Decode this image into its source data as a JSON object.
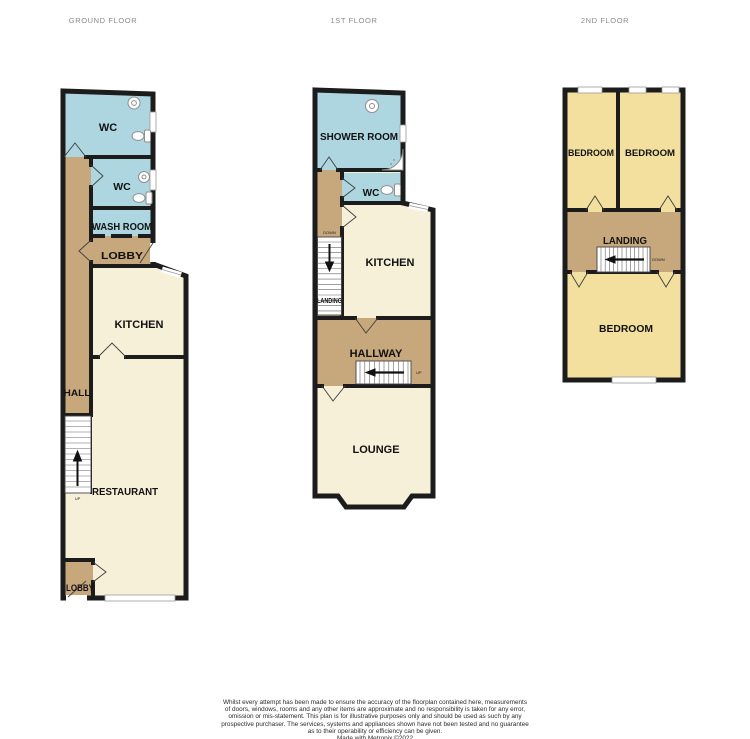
{
  "titles": {
    "ground": "GROUND FLOOR",
    "first": "1ST FLOOR",
    "second": "2ND FLOOR"
  },
  "colors": {
    "wall": "#1c1c1c",
    "cream": "#f6f0d8",
    "blue": "#aed6e0",
    "tan": "#c7a77c",
    "yellow": "#f3e09f",
    "title_gray": "#8a8a8a"
  },
  "ground": {
    "rooms": {
      "wc1": "WC",
      "wc2": "WC",
      "wash": "WASH ROOM",
      "lobby1": "LOBBY",
      "kitchen": "KITCHEN",
      "hall": "HALL",
      "restaurant": "RESTAURANT",
      "lobby2": "LOBBY"
    },
    "stairs": {
      "up": "UP"
    }
  },
  "first": {
    "rooms": {
      "shower": "SHOWER ROOM",
      "wc": "WC",
      "kitchen": "KITCHEN",
      "landing": "LANDING",
      "hallway": "HALLWAY",
      "lounge": "LOUNGE"
    },
    "stairs": {
      "down": "DOWN",
      "up": "UP"
    }
  },
  "second": {
    "rooms": {
      "bedroom1": "BEDROOM",
      "bedroom2": "BEDROOM",
      "landing": "LANDING",
      "bedroom3": "BEDROOM"
    },
    "stairs": {
      "down": "DOWN"
    }
  },
  "footer": {
    "line1": "Whilst every attempt has been made to ensure the accuracy of the floorplan contained here, measurements",
    "line2": "of doors, windows, rooms and any other items are approximate and no responsibility is taken for any error,",
    "line3": "omission or mis-statement. This plan is for illustrative purposes only and should be used as such by any",
    "line4": "prospective purchaser. The services, systems and appliances shown have not been tested and no guarantee",
    "line5": "as to their operability or efficiency can be given.",
    "line6": "Made with Metropix ©2022"
  }
}
